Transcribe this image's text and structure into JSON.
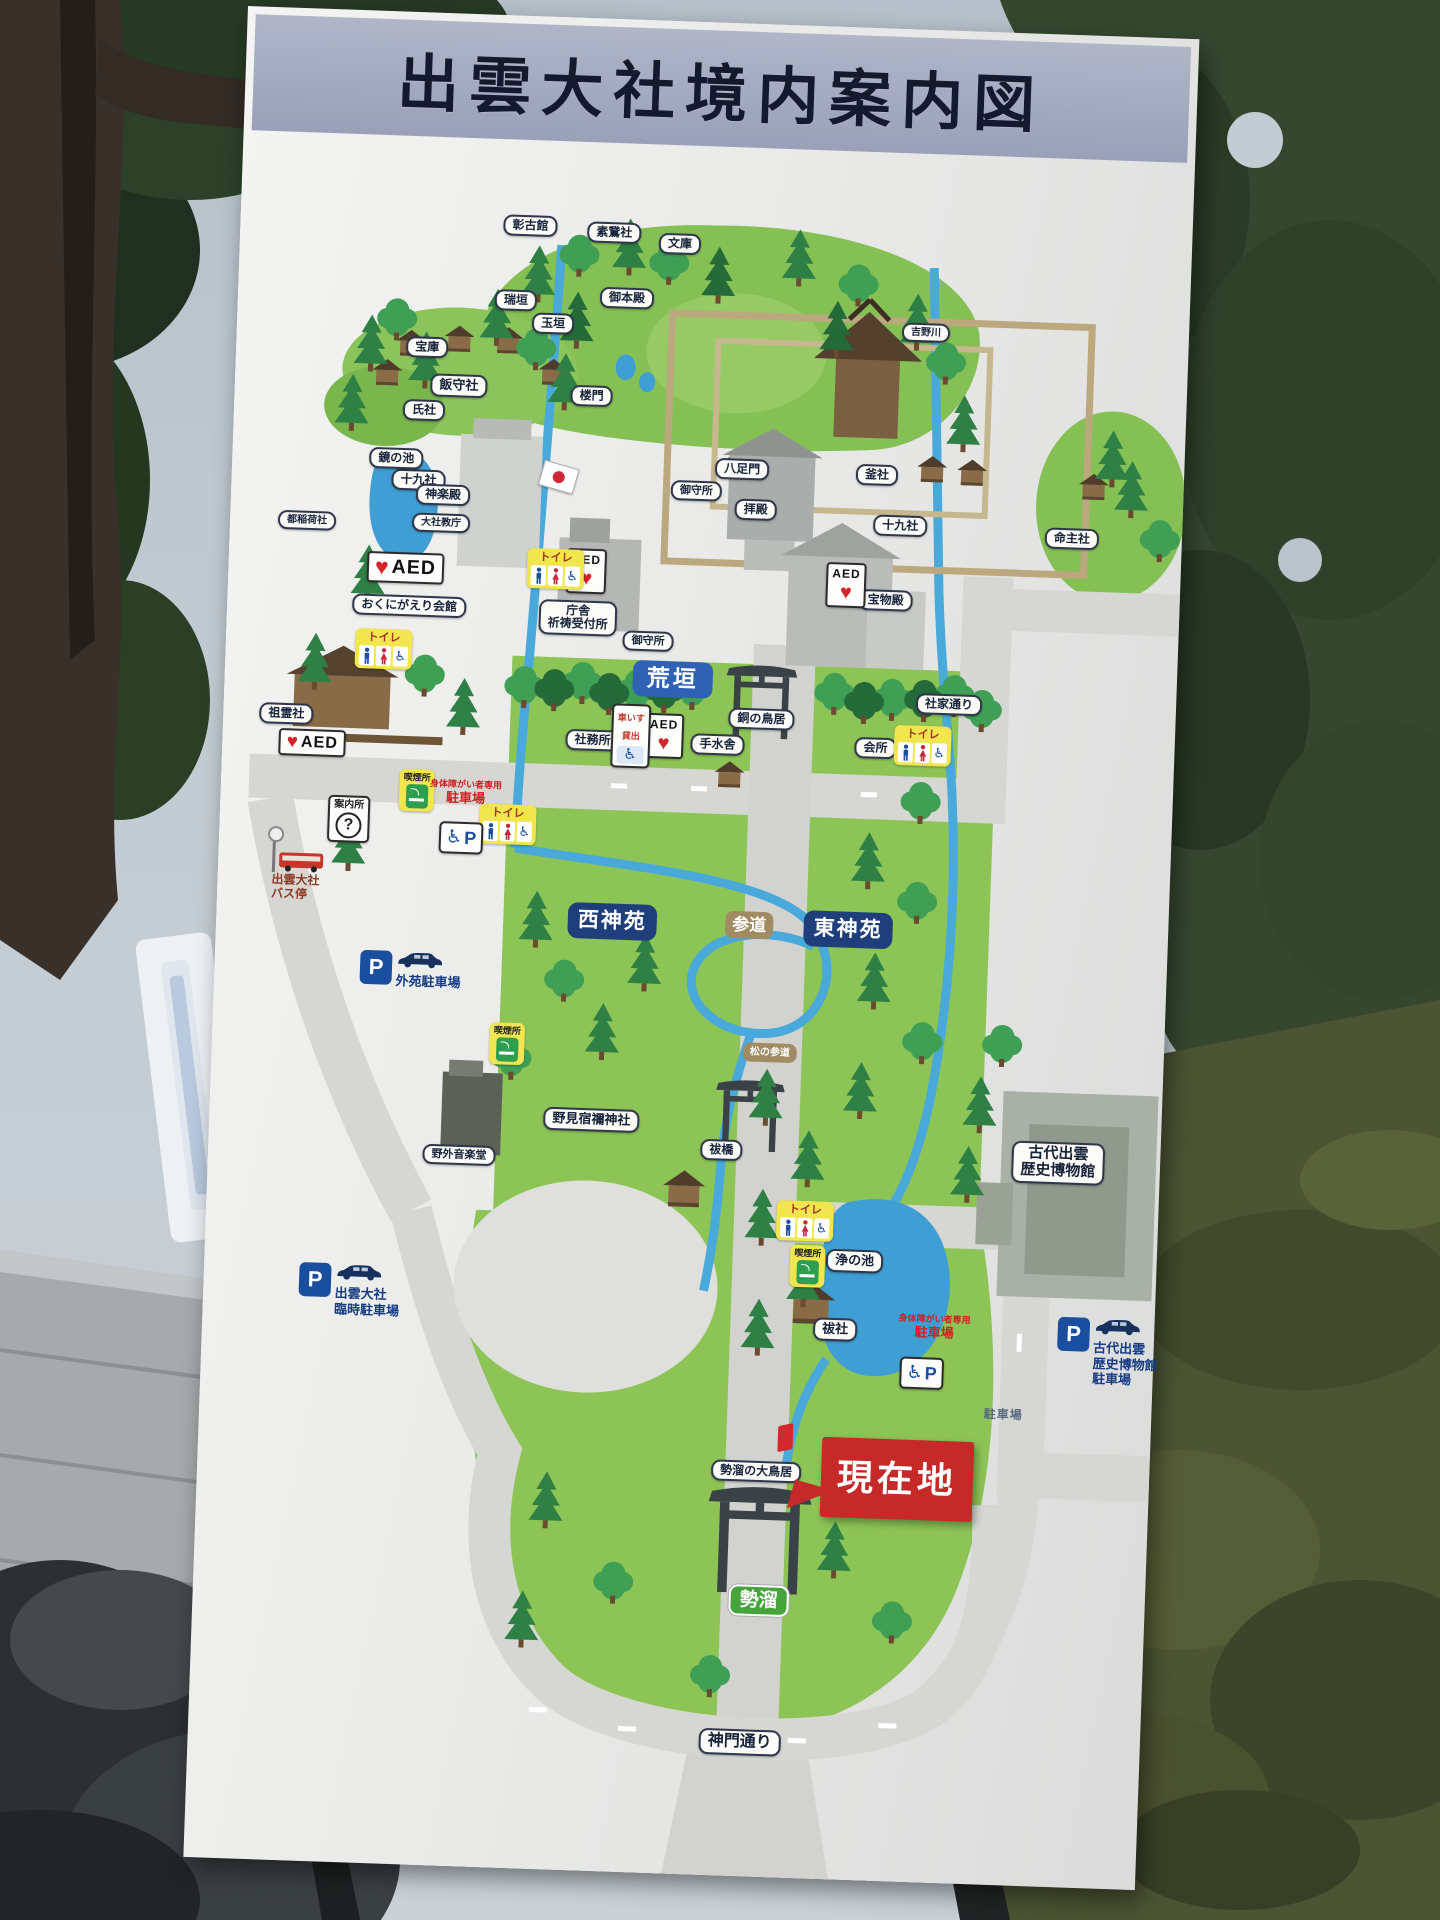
{
  "title": "出雲大社境内案内図",
  "aed": "AED",
  "map": {
    "labels": [
      {
        "id": "shokokan",
        "type": "pill",
        "text": "彰古館",
        "x": 290,
        "y": 210,
        "fs": 12
      },
      {
        "id": "sogasha",
        "type": "pill",
        "text": "素鵞社",
        "x": 374,
        "y": 214,
        "fs": 12
      },
      {
        "id": "bunko",
        "type": "pill",
        "text": "文庫",
        "x": 440,
        "y": 223,
        "fs": 12
      },
      {
        "id": "mizugaki",
        "type": "pill",
        "text": "瑞垣",
        "x": 278,
        "y": 285,
        "fs": 12
      },
      {
        "id": "gohonden",
        "type": "pill",
        "text": "御本殿",
        "x": 389,
        "y": 279,
        "fs": 12
      },
      {
        "id": "tamagaki",
        "type": "pill",
        "text": "玉垣",
        "x": 316,
        "y": 307,
        "fs": 12
      },
      {
        "id": "roumon",
        "type": "pill",
        "text": "楼門",
        "x": 357,
        "y": 378,
        "fs": 12
      },
      {
        "id": "yatsuashimon",
        "type": "pill",
        "text": "八足門",
        "x": 510,
        "y": 446,
        "fs": 12
      },
      {
        "id": "hoko",
        "type": "pill",
        "text": "宝庫",
        "x": 191,
        "y": 335,
        "fs": 12
      },
      {
        "id": "ujisha",
        "type": "pill",
        "text": "氏社",
        "x": 190,
        "y": 398,
        "fs": 12
      },
      {
        "id": "jukusha-west",
        "type": "pill",
        "text": "十九社",
        "x": 187,
        "y": 468,
        "fs": 12
      },
      {
        "id": "omamoridokoro-upper",
        "type": "pill",
        "text": "御守所",
        "x": 465,
        "y": 469,
        "fs": 11
      },
      {
        "id": "haiden",
        "type": "pill",
        "text": "拝殿",
        "x": 525,
        "y": 486,
        "fs": 12
      },
      {
        "id": "kamasha",
        "type": "pill",
        "text": "釜社",
        "x": 645,
        "y": 447,
        "fs": 12
      },
      {
        "id": "jukusha-east",
        "type": "pill",
        "text": "十九社",
        "x": 670,
        "y": 497,
        "fs": 12
      },
      {
        "id": "inochinushisha",
        "type": "pill",
        "text": "命主社",
        "x": 842,
        "y": 504,
        "fs": 12
      },
      {
        "id": "yoshinogawa",
        "type": "pill",
        "text": "吉野川",
        "x": 689,
        "y": 303,
        "fs": 10
      },
      {
        "id": "homotsuden",
        "type": "pill",
        "text": "宝物殿",
        "x": 658,
        "y": 572,
        "fs": 12
      },
      {
        "id": "chosha",
        "type": "pill",
        "text": "庁舎\n祈祷受付所",
        "x": 351,
        "y": 600,
        "fs": 12
      },
      {
        "id": "omamoridokoro-lower",
        "type": "pill",
        "text": "御守所",
        "x": 422,
        "y": 621,
        "fs": 11
      },
      {
        "id": "dou-no-torii",
        "type": "pill",
        "text": "銅の鳥居",
        "x": 538,
        "y": 695,
        "fs": 12
      },
      {
        "id": "shake-dori",
        "type": "pill",
        "text": "社家通り",
        "x": 725,
        "y": 674,
        "fs": 12
      },
      {
        "id": "shamusho",
        "type": "pill",
        "text": "社務所",
        "x": 370,
        "y": 722,
        "fs": 12
      },
      {
        "id": "chozuya",
        "type": "pill",
        "text": "手水舎",
        "x": 495,
        "y": 722,
        "fs": 12
      },
      {
        "id": "kaisho",
        "type": "pill",
        "text": "会所",
        "x": 653,
        "y": 720,
        "fs": 12
      },
      {
        "id": "iimorisha",
        "type": "pill",
        "text": "飯守社",
        "x": 224,
        "y": 372,
        "fs": 13
      },
      {
        "id": "kagami-no-ike",
        "type": "pill",
        "text": "鏡の池",
        "x": 164,
        "y": 447,
        "fs": 12
      },
      {
        "id": "kaguraden",
        "type": "pill",
        "text": "神楽殿",
        "x": 212,
        "y": 482,
        "fs": 12
      },
      {
        "id": "taishakyocho",
        "type": "pill",
        "text": "大社教庁",
        "x": 211,
        "y": 510,
        "fs": 10
      },
      {
        "id": "miyako-inarisha",
        "type": "pill",
        "text": "都稲荷社",
        "x": 77,
        "y": 512,
        "fs": 10
      },
      {
        "id": "okunigaeri-kaikan",
        "type": "pill",
        "text": "おくにがえり会館",
        "x": 182,
        "y": 594,
        "fs": 12
      },
      {
        "id": "soreisha",
        "type": "pill",
        "text": "祖霊社",
        "x": 63,
        "y": 706,
        "fs": 12
      },
      {
        "id": "nominosukune-jinja",
        "type": "pill",
        "text": "野見宿禰神社",
        "x": 382,
        "y": 1101,
        "fs": 13
      },
      {
        "id": "haraebashi",
        "type": "pill",
        "text": "祓橋",
        "x": 513,
        "y": 1127,
        "fs": 12
      },
      {
        "id": "yagai-ongakudo",
        "type": "pill",
        "text": "野外音楽堂",
        "x": 251,
        "y": 1141,
        "fs": 11
      },
      {
        "id": "matsu-no-sando",
        "type": "tan",
        "text": "松の参道",
        "x": 558,
        "y": 1028,
        "fs": 10
      },
      {
        "id": "kiyo-no-ike",
        "type": "pill",
        "text": "浄の池",
        "x": 650,
        "y": 1233,
        "fs": 13
      },
      {
        "id": "harae-no-yashiro",
        "type": "pill",
        "text": "祓社",
        "x": 633,
        "y": 1302,
        "fs": 13
      },
      {
        "id": "seidamari-no-otorii",
        "type": "pill",
        "text": "勢溜の大鳥居",
        "x": 559,
        "y": 1447,
        "fs": 12
      },
      {
        "id": "shinmon-dori",
        "type": "pill",
        "text": "神門通り",
        "x": 552,
        "y": 1718,
        "fs": 16
      },
      {
        "id": "kodai-izumo-museum",
        "type": "pill",
        "text": "古代出雲\n歴史博物館",
        "x": 850,
        "y": 1128,
        "fs": 15
      },
      {
        "id": "aragaki",
        "type": "blue",
        "text": "荒垣",
        "x": 448,
        "y": 658
      },
      {
        "id": "nishi-shinen",
        "type": "navy",
        "text": "西神苑",
        "x": 396,
        "y": 902
      },
      {
        "id": "sando",
        "type": "tan",
        "text": "参道",
        "x": 533,
        "y": 901,
        "fs": 17
      },
      {
        "id": "higashi-shinen",
        "type": "navy",
        "text": "東神苑",
        "x": 632,
        "y": 902
      },
      {
        "id": "seidamari",
        "type": "greenl",
        "text": "勢溜",
        "x": 566,
        "y": 1576
      },
      {
        "id": "genzaichi",
        "type": "redbox",
        "text": "現在地",
        "x": 700,
        "y": 1450
      },
      {
        "id": "genzaichi-marker",
        "type": "marker",
        "x": 587,
        "y": 1412
      },
      {
        "id": "aed-kaguraden",
        "type": "aed-h",
        "x": 177,
        "y": 556,
        "s": 1.15
      },
      {
        "id": "aed-soreisha",
        "type": "aed-h",
        "x": 90,
        "y": 734,
        "s": 0.95
      },
      {
        "id": "aed-chosha",
        "type": "aed-v",
        "x": 358,
        "y": 553
      },
      {
        "id": "aed-shamusho",
        "type": "aed-v",
        "x": 441,
        "y": 715
      },
      {
        "id": "aed-homotsuden",
        "type": "aed-v",
        "x": 618,
        "y": 558
      },
      {
        "id": "toilet-kaguraden",
        "type": "toilet",
        "title": "トイレ",
        "x": 158,
        "y": 638
      },
      {
        "id": "toilet-chosha",
        "type": "toilet",
        "title": "トイレ",
        "x": 327,
        "y": 552
      },
      {
        "id": "toilet-shamusho",
        "type": "toilet",
        "title": "トイレ",
        "x": 288,
        "y": 809
      },
      {
        "id": "toilet-kaisho",
        "type": "toilet",
        "title": "トイレ",
        "x": 700,
        "y": 716
      },
      {
        "id": "toilet-ike",
        "type": "toilet",
        "title": "トイレ",
        "x": 599,
        "y": 1195
      },
      {
        "id": "smoking-1",
        "type": "smoke",
        "title": "喫煙所",
        "x": 196,
        "y": 778
      },
      {
        "id": "smoking-2",
        "type": "smoke",
        "title": "喫煙所",
        "x": 295,
        "y": 1028
      },
      {
        "id": "smoking-3",
        "type": "smoke",
        "title": "喫煙所",
        "x": 603,
        "y": 1240
      },
      {
        "id": "information",
        "type": "info",
        "title": "案内所",
        "q": "?",
        "x": 129,
        "y": 809
      },
      {
        "id": "wheelchair-rental",
        "type": "rent",
        "title": "車いす\n貸出",
        "x": 408,
        "y": 716
      },
      {
        "id": "disabled-parking-sign-1",
        "type": "pwheel",
        "p": "P",
        "x": 242,
        "y": 824
      },
      {
        "id": "disabled-parking-sign-2",
        "type": "pwheel",
        "p": "P",
        "x": 721,
        "y": 1343
      },
      {
        "id": "disabled-parking-text-1",
        "type": "redtext",
        "text": "身体障がい者専用",
        "bold": "駐車場",
        "x": 245,
        "y": 779
      },
      {
        "id": "disabled-parking-text-2",
        "type": "redtext",
        "text": "身体障がい者専用",
        "bold": "駐車場",
        "x": 732,
        "y": 1297
      },
      {
        "id": "bus-stop",
        "type": "bus",
        "text": "出雲大社\nバス停",
        "x": 80,
        "y": 862
      },
      {
        "id": "gaien-parking",
        "type": "pgroup",
        "p": "P",
        "text": "外苑駐車場",
        "x": 196,
        "y": 958
      },
      {
        "id": "rinji-parking",
        "type": "pgroup",
        "p": "P",
        "text": "出雲大社\n臨時駐車場",
        "x": 146,
        "y": 1280
      },
      {
        "id": "museum-parking",
        "type": "pgroup",
        "p": "P",
        "text": "古代出雲\n歴史博物館\n駐車場",
        "x": 906,
        "y": 1316
      },
      {
        "id": "parking-lot",
        "type": "graytxt",
        "text": "駐車場",
        "x": 804,
        "y": 1382
      },
      {
        "id": "hinomaru-flag",
        "type": "flag",
        "x": 327,
        "y": 460
      }
    ]
  }
}
